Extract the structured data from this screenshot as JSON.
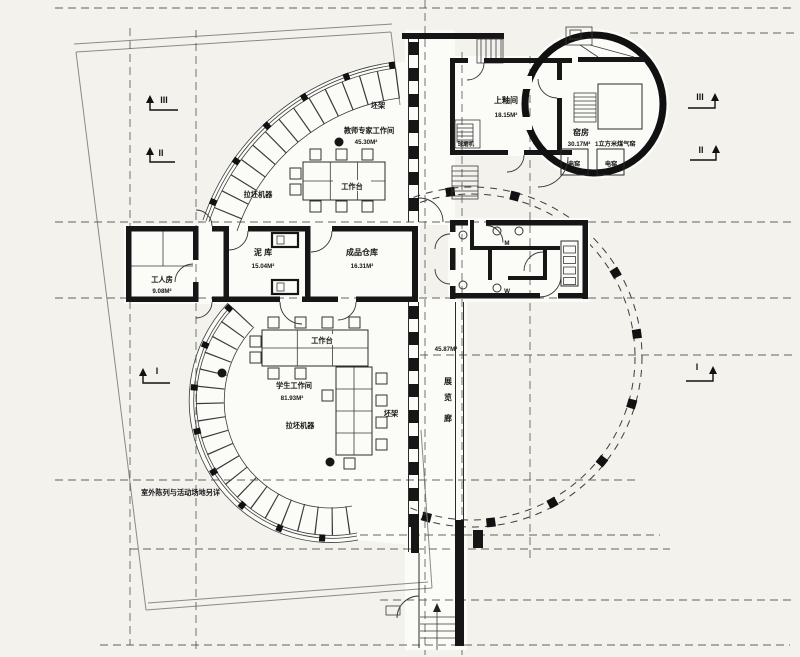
{
  "colors": {
    "paper": "#f3f2ed",
    "ink": "#1a1a1a"
  },
  "rooms": {
    "teacher_studio": {
      "name": "教师专家工作间",
      "area": "45.30M²"
    },
    "student_studio": {
      "name": "学生工作间",
      "area": "81.93M²"
    },
    "glaze_room": {
      "name": "上釉间",
      "area": "18.15M²"
    },
    "kiln_room": {
      "name": "窑房",
      "area": "30.17M²",
      "gas_kiln_note": "1立方米煤气窑"
    },
    "clay_store": {
      "name": "泥 库",
      "area": "15.04M²"
    },
    "product_store": {
      "name": "成品仓库",
      "area": "16.31M²"
    },
    "worker_room": {
      "name": "工人房",
      "area": "9.08M²"
    },
    "exhibition_gallery": {
      "area": "45.87M²",
      "char1": "展",
      "char2": "览",
      "char3": "廊"
    }
  },
  "equipment": {
    "worktable": "工作台",
    "throwing_wheels": "拉坯机器",
    "clay_rack": "坯架",
    "electric_kiln": "电窑",
    "ball_mill": "球磨机"
  },
  "fixtures": {
    "male": "M",
    "female": "W"
  },
  "notes": {
    "outdoor": "室外陈列与活动场地另详"
  },
  "section_markers": {
    "one": "I",
    "two": "II",
    "three": "III"
  }
}
